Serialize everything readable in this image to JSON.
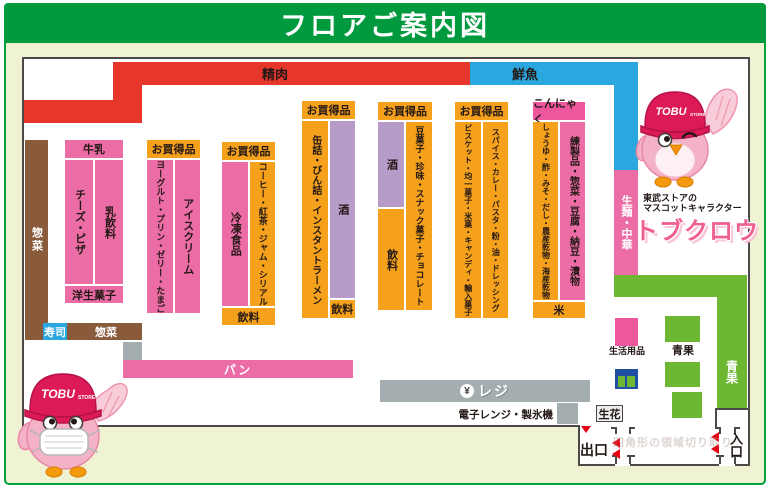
{
  "title": "フロアご案内図",
  "zones": {
    "meat": "精肉",
    "fish": "鮮魚",
    "sozai_left": "惣菜",
    "sushi": "寿司",
    "sozai_bottom": "惣菜",
    "bread": "パン",
    "noodles": "生麺・中華",
    "produce_bar": "青果",
    "produce_label": "青果",
    "daily_goods": "生活用品",
    "flowers": "生花"
  },
  "blocks": [
    {
      "header": "牛乳",
      "cols": [
        {
          "text": "チーズ・ピザ"
        },
        {
          "text": "乳飲料"
        }
      ],
      "footer": "洋生菓子"
    },
    {
      "header": "お買得品",
      "cols": [
        {
          "text": "ヨーグルト・プリン・ゼリー・たまご"
        },
        {
          "text": "アイスクリーム"
        }
      ]
    },
    {
      "header": "お買得品",
      "cols": [
        {
          "text": "冷凍食品"
        },
        {
          "text": "コーヒー・紅茶・ジャム・シリアル"
        }
      ],
      "footer": "飲料"
    },
    {
      "header": "お買得品",
      "cols": [
        {
          "text": "缶詰・びん詰・インスタントラーメン"
        },
        {
          "text": "酒",
          "footer": "飲料"
        }
      ]
    },
    {
      "header": "お買得品",
      "cols": [
        {
          "text": "酒",
          "footer": "飲料"
        },
        {
          "text": "豆菓子・珍味・スナック菓子・チョコレート"
        }
      ]
    },
    {
      "header": "お買得品",
      "cols": [
        {
          "text": "ビスケット・均一菓子・米菓・キャンディ・輸入菓子"
        },
        {
          "text": "スパイス・カレー・パスタ・粉・油・ドレッシング"
        }
      ]
    },
    {
      "header": "こんにゃく",
      "cols": [
        {
          "text": "しょうゆ・酢・みそ・だし・農産乾物・海産乾物"
        },
        {
          "text": "練製品・惣菜・豆腐・納豆・漬物"
        }
      ],
      "footer": "米"
    }
  ],
  "checkout": {
    "register": "レジ",
    "yen": "¥",
    "microwave": "電子レンジ・製氷機"
  },
  "doors": {
    "exit": "出口",
    "entrance": "入口"
  },
  "mascot": {
    "caption1": "東武ストアの",
    "caption2": "マスコットキャラクター",
    "name": "トブクロウ",
    "cap_main": "TOBU",
    "cap_sub": "STORE"
  },
  "watermark": "四角形の領域切り取り",
  "colors": {
    "frame_green": "#00a13b",
    "title_green": "#009a3e",
    "cream": "#eff3d3",
    "meat_red": "#e7362c",
    "fish_blue": "#2aa7de",
    "pink": "#ec6ca6",
    "bright_pink": "#ee579e",
    "orange": "#f5a11c",
    "sake_purple": "#b79bc8",
    "sozai_brown": "#8a5b3a",
    "register_gray": "#a4aeb1",
    "produce_green": "#6db733",
    "text_dark": "#231815",
    "arrow_red": "#e60012",
    "goods_icon_blue": "#1d50a2"
  }
}
